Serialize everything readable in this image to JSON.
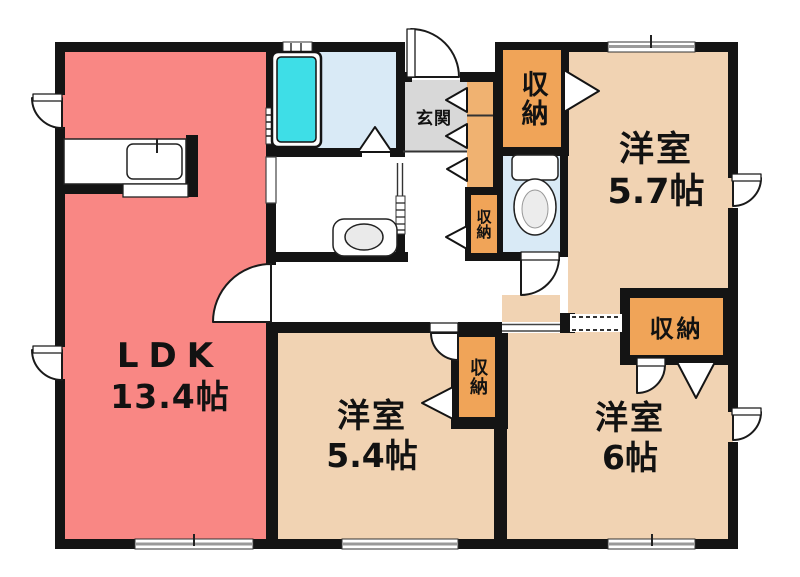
{
  "plan_title": "apartment-floor-plan",
  "rooms": [
    {
      "id": "ldk",
      "label": "LDK",
      "size": "13.4帖"
    },
    {
      "id": "bedroom-5-7",
      "label": "洋室",
      "size": "5.7帖"
    },
    {
      "id": "bedroom-5-4",
      "label": "洋室",
      "size": "5.4帖"
    },
    {
      "id": "bedroom-6",
      "label": "洋室",
      "size": "6帖"
    },
    {
      "id": "genkan",
      "label": "玄関",
      "size": ""
    }
  ],
  "closets": [
    {
      "id": "closet-entry-hall",
      "label": "収納"
    },
    {
      "id": "closet-hallway",
      "label": "収納"
    },
    {
      "id": "closet-bedroom-5-4",
      "label": "収納"
    },
    {
      "id": "closet-bedroom-6",
      "label": "収納"
    }
  ],
  "fixtures": [
    {
      "id": "bathtub",
      "icon": "bathtub-icon"
    },
    {
      "id": "toilet",
      "icon": "toilet-icon"
    },
    {
      "id": "wash-basin",
      "icon": "wash-basin-icon"
    },
    {
      "id": "kitchen-sink",
      "icon": "kitchen-sink-icon"
    }
  ],
  "colors": {
    "ldk": "#F98784",
    "bedroom": "#F1D3B3",
    "closet": "#F0A458",
    "closet_light": "#F0B271",
    "genkan": "#D8D8D8",
    "wet_room": "#D9EAF6",
    "bathtub": "#3EDEE7",
    "wall": "#141414"
  }
}
